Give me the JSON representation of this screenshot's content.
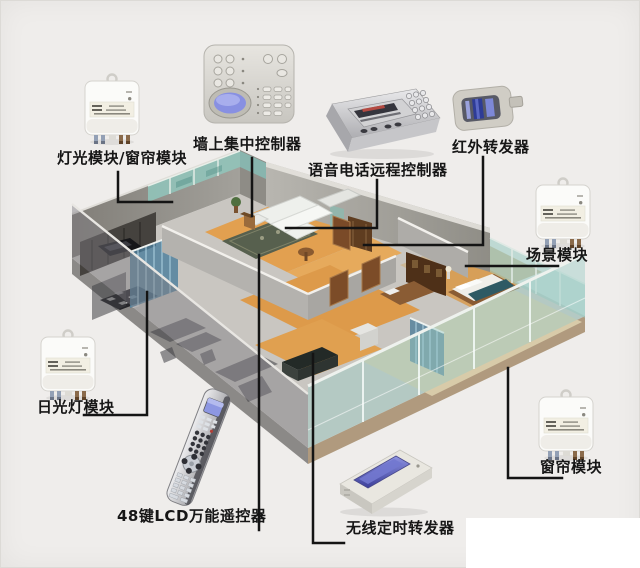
{
  "palette": {
    "background": "#efedeb",
    "corner_patch": "#ffffff",
    "connector_line": "#141414",
    "wood_floor": "#e2a050",
    "glass_teal": "#9cc8c0",
    "wall_gray": "#a8a6a0",
    "lcd_blue": "#8890e2"
  },
  "devices": [
    {
      "id": "light-curtain-module",
      "label": "灯光模块/窗帘模块",
      "kind": "wall-module"
    },
    {
      "id": "wall-central-controller",
      "label": "墙上集中控制器",
      "kind": "wall-control-panel"
    },
    {
      "id": "voice-phone-remote-controller",
      "label": "语音电话远程控制器",
      "kind": "desktop-console"
    },
    {
      "id": "ir-repeater",
      "label": "红外转发器",
      "kind": "infrared-repeater"
    },
    {
      "id": "scene-module",
      "label": "场景模块",
      "kind": "wall-module"
    },
    {
      "id": "fluorescent-light-module",
      "label": "日光灯模块",
      "kind": "wall-module"
    },
    {
      "id": "lcd-remote-48key",
      "label": "48键LCD万能遥控器",
      "kind": "remote-control"
    },
    {
      "id": "wireless-timer-repeater",
      "label": "无线定时转发器",
      "kind": "desktop-transmitter"
    },
    {
      "id": "curtain-module",
      "label": "窗帘模块",
      "kind": "wall-module"
    }
  ]
}
